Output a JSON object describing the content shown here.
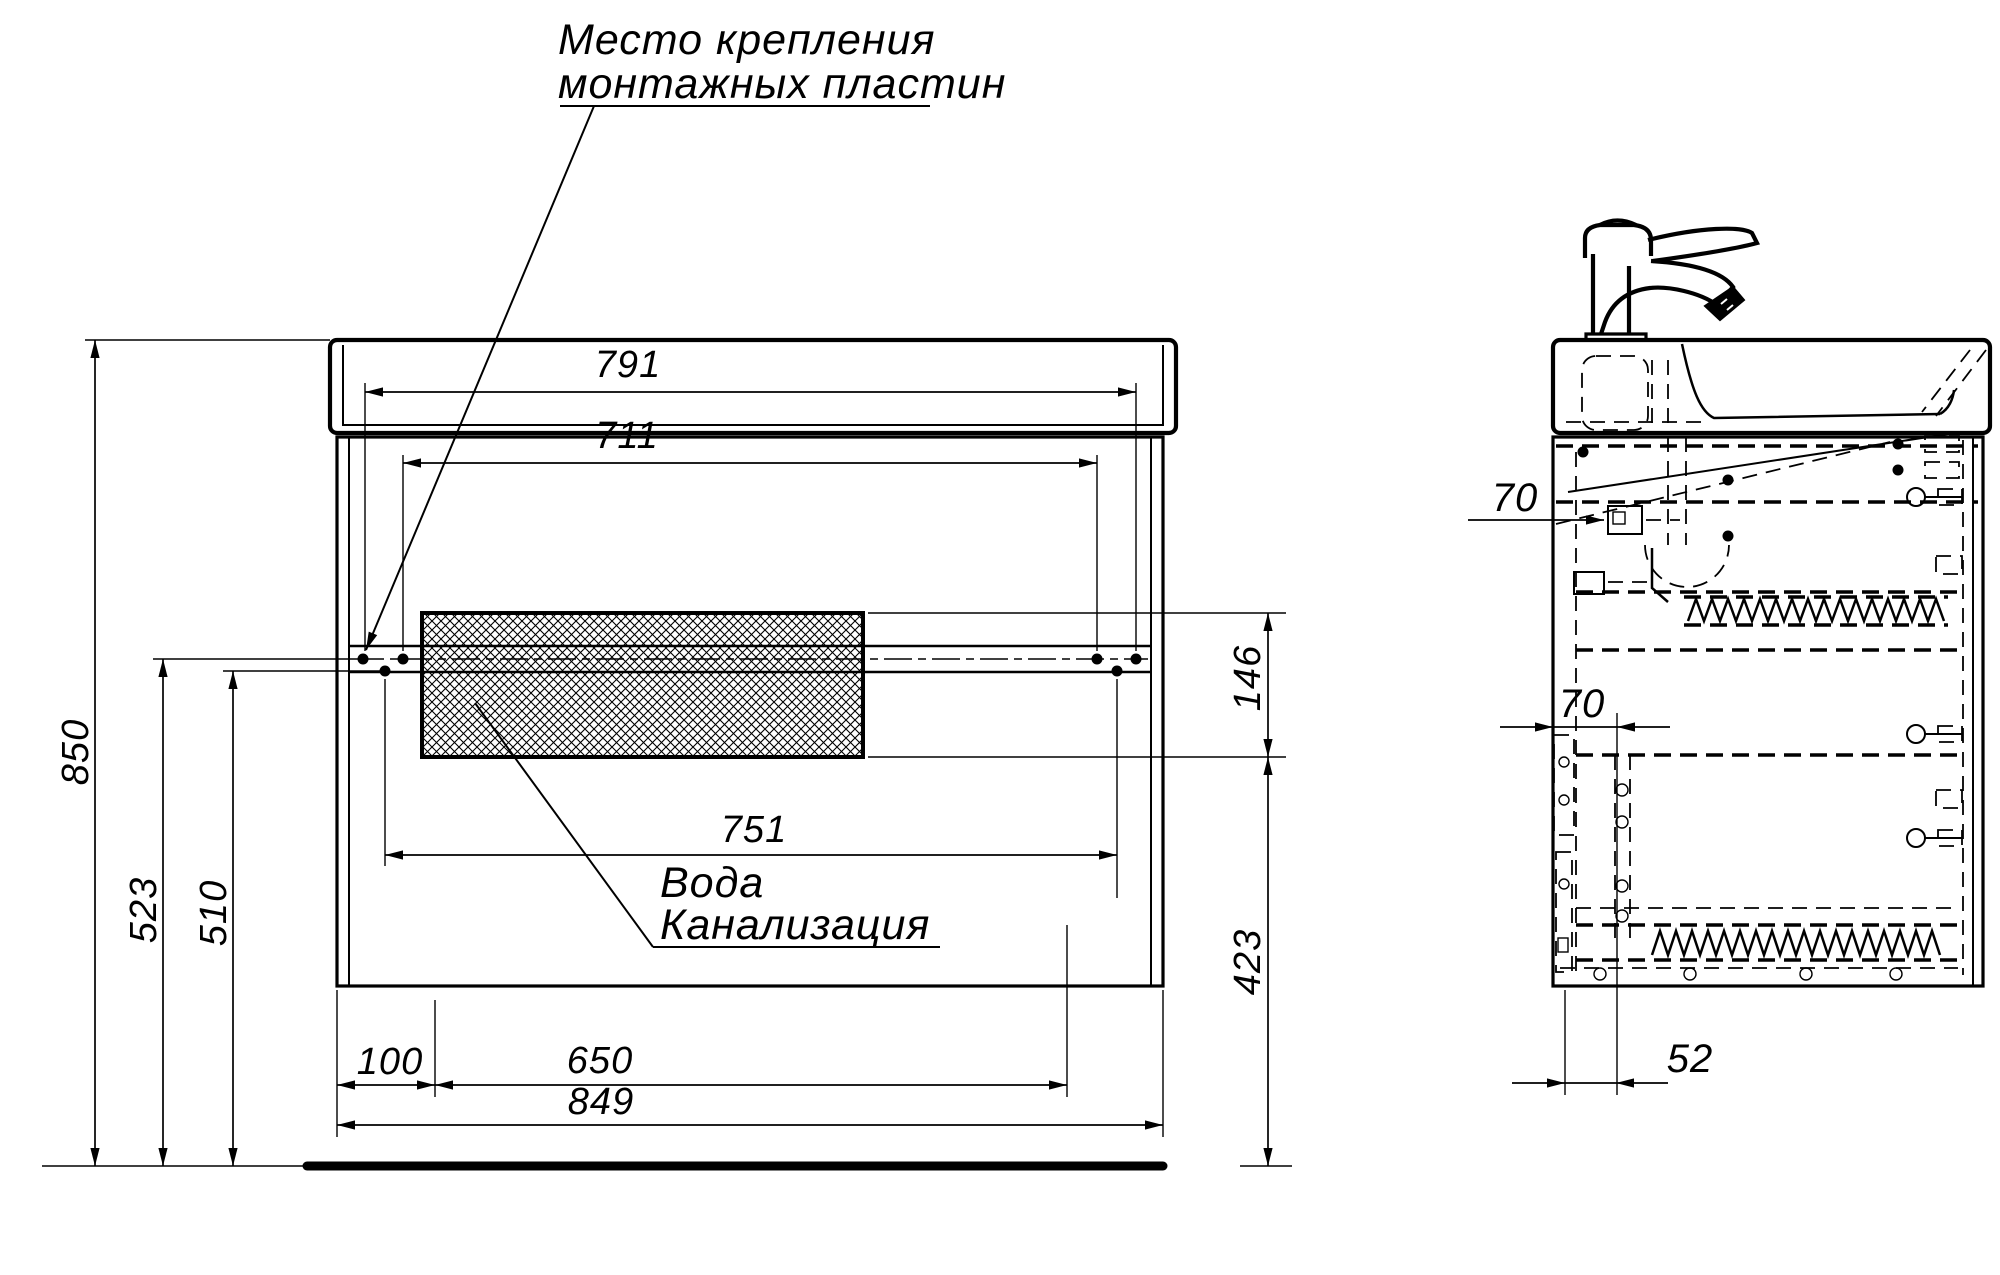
{
  "drawing": {
    "note": {
      "line1": "Место крепления",
      "line2": "монтажных пластин"
    },
    "labels": {
      "water": "Вода",
      "sewer": "Канализация"
    },
    "dims": {
      "w791": "791",
      "w711": "711",
      "w751": "751",
      "h850": "850",
      "h523": "523",
      "h510": "510",
      "h146": "146",
      "h423": "423",
      "w100": "100",
      "w650": "650",
      "w849": "849",
      "s70_upper": "70",
      "s70_lower": "70",
      "s52": "52"
    },
    "colors": {
      "line": "#000000",
      "background": "#ffffff"
    }
  }
}
